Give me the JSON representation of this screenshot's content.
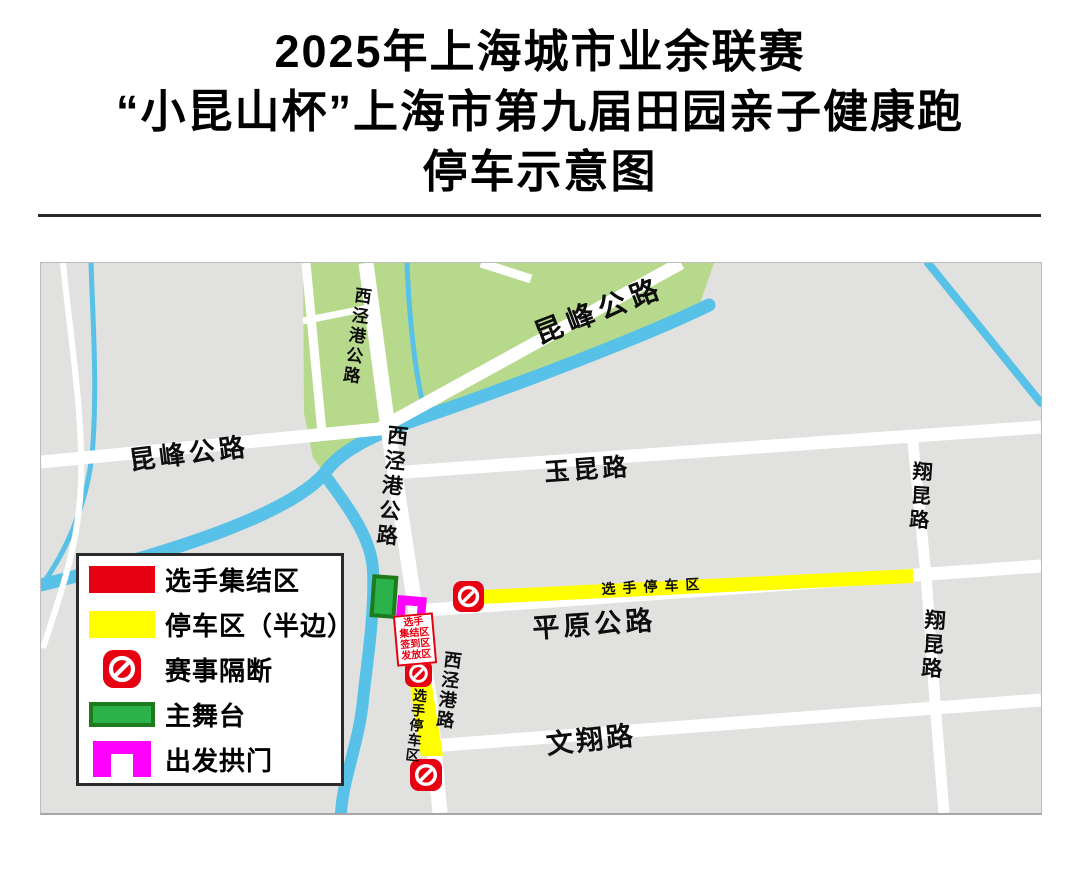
{
  "title": {
    "line1": "2025年上海城市业余联赛",
    "line2": "“小昆山杯”上海市第九届田园亲子健康跑",
    "line3": "停车示意图"
  },
  "map": {
    "roads": {
      "kunfeng_left": "昆峰公路",
      "kunfeng_diagonal": "昆峰公路",
      "xijinggang_highway_top": "西泾港公路",
      "xijinggang_highway_mid": "西泾港公路",
      "yukun": "玉昆路",
      "xiangkun_upper": "翔昆路",
      "xiangkun_lower": "翔昆路",
      "pingyuan": "平原公路",
      "xijinggang_road": "西泾港路",
      "wenxiang": "文翔路"
    },
    "zones": {
      "parking_strip_horizontal": "选手停车区",
      "parking_strip_vertical": "选手停车区",
      "assembly_sign_lines": [
        "选手",
        "集结区",
        "签到区",
        "发放区"
      ]
    }
  },
  "legend": {
    "items": [
      {
        "id": "assembly",
        "label": "选手集结区"
      },
      {
        "id": "parking",
        "label": "停车区（半边）"
      },
      {
        "id": "barrier",
        "label": "赛事隔断"
      },
      {
        "id": "stage",
        "label": "主舞台"
      },
      {
        "id": "arch",
        "label": "出发拱门"
      }
    ]
  },
  "colors": {
    "land": "#e1e1df",
    "road": "#ffffff",
    "water": "#57c1e8",
    "park": "#b7d98c",
    "parking-yellow": "#ffff00",
    "event-red": "#e60012",
    "arch-magenta": "#ff00ff",
    "stage-green": "#2bb24a",
    "stage-border": "#1d7a1d"
  }
}
